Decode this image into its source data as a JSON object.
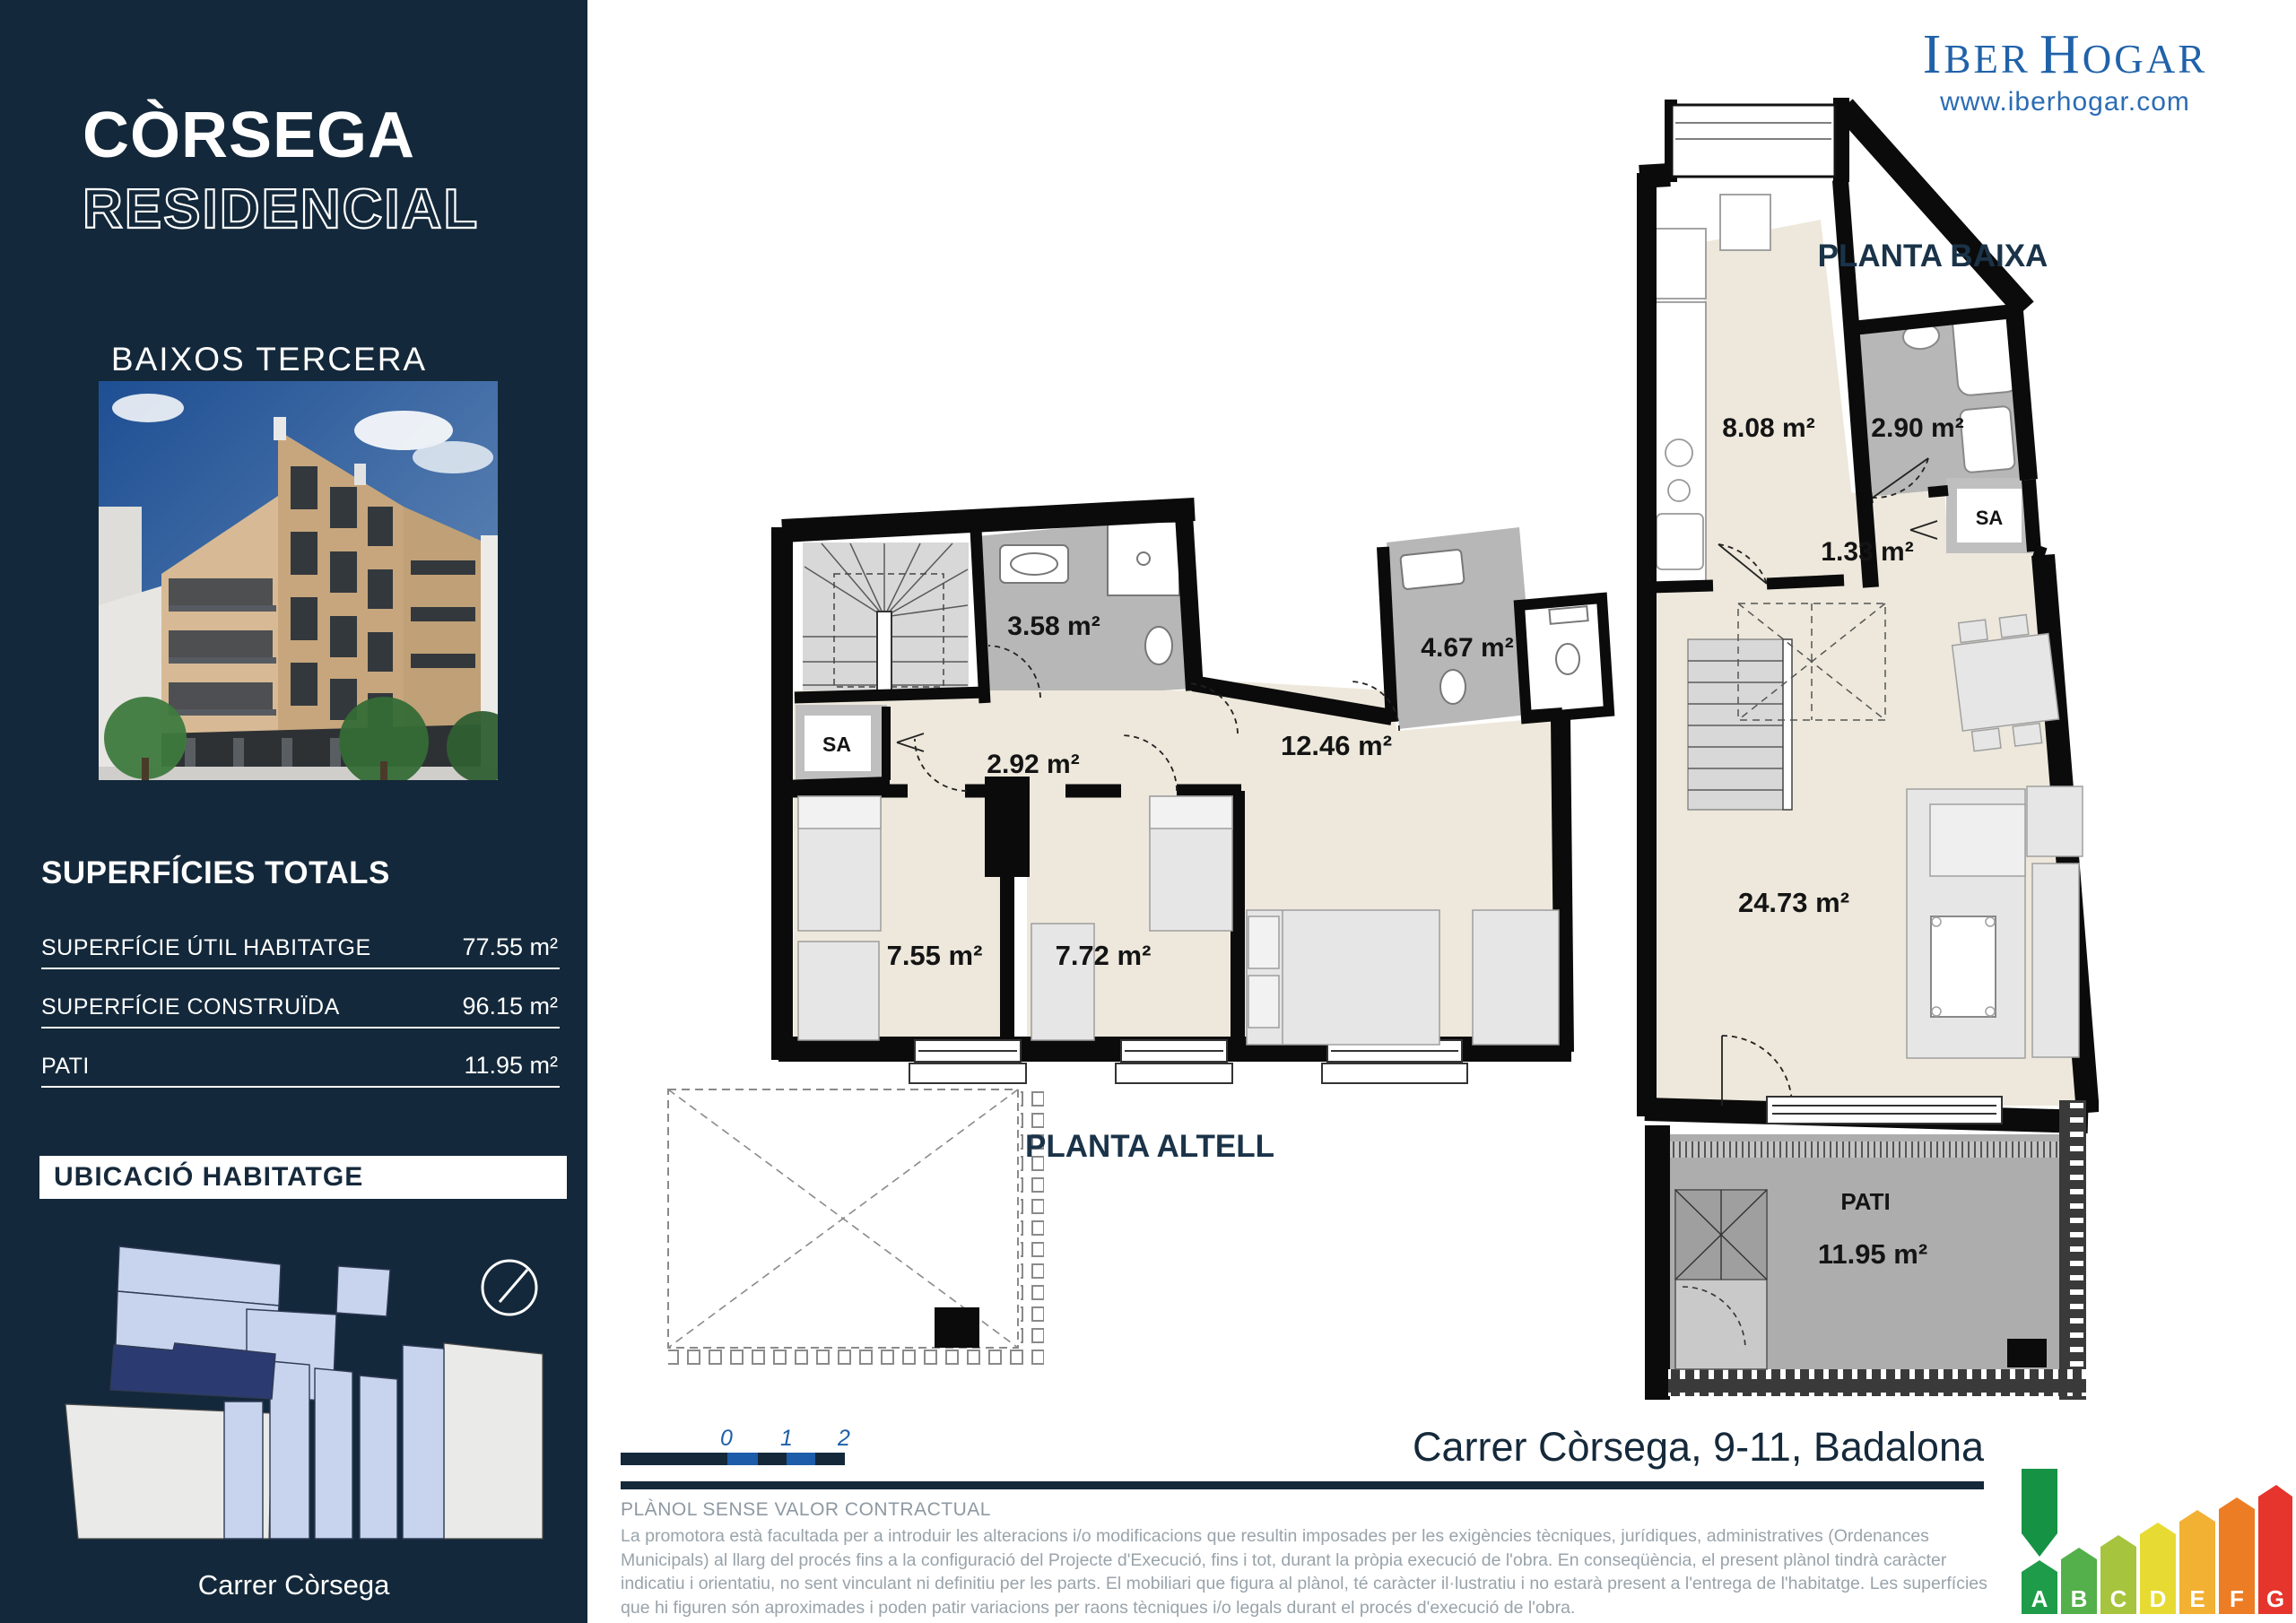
{
  "brand": {
    "navy": "#13283A",
    "logo_blue": "#2062A9",
    "accent_blue": "#1D5CA9",
    "site_highlight": "#2B3B72",
    "site_block_blue": "#C8D4EE"
  },
  "sidebar": {
    "title_line1": "CÒRSEGA",
    "title_line2": "RESIDENCIAL",
    "subtitle": "BAIXOS TERCERA",
    "superficies": {
      "heading": "SUPERFÍCIES TOTALS",
      "rows": [
        {
          "label": "SUPERFÍCIE ÚTIL HABITATGE",
          "value": "77.55 m²"
        },
        {
          "label": "SUPERFÍCIE CONSTRUÏDA",
          "value": "96.15 m²"
        },
        {
          "label": "PATI",
          "value": "11.95 m²"
        }
      ]
    },
    "ubicacio_heading": "UBICACIÓ HABITATGE",
    "street_label": "Carrer Còrsega"
  },
  "logo": {
    "i": "I",
    "ber": "BER",
    "h": "H",
    "ogar": "OGAR",
    "website": "www.iberhogar.com"
  },
  "plans": {
    "altell": {
      "title": "PLANTA ALTELL",
      "bath_top": "3.58 m²",
      "hall": "2.92 m²",
      "sa": "SA",
      "bedroom1": "7.55 m²",
      "bedroom2": "7.72 m²",
      "bedroom3": "12.46 m²",
      "bath_right": "4.67 m²"
    },
    "baixa": {
      "title": "PLANTA BAIXA",
      "kitchen": "8.08 m²",
      "bath": "2.90 m²",
      "hall": "1.33 m²",
      "sa": "SA",
      "living": "24.73 m²",
      "pati_title": "PATI",
      "pati_area": "11.95 m²"
    }
  },
  "scalebar": {
    "labels": [
      "0",
      "1",
      "2"
    ]
  },
  "address": "Carrer Còrsega, 9-11, Badalona",
  "disclaimer": {
    "title": "PLÀNOL SENSE VALOR CONTRACTUAL",
    "body": "La promotora està facultada per a introduir les alteracions i/o modificacions que resultin imposades per les exigències tècniques, jurídiques, administratives (Ordenances Municipals) al llarg del procés fins a la configuració del Projecte d'Execució, fins i tot, durant la pròpia execució de l'obra. En conseqüència, el present plànol tindrà caràcter indicatiu i orientatiu, no sent vinculant ni definitiu per les parts. El mobiliari que figura al plànol, té caràcter il·lustratiu i no estarà present a l'entrega de l'habitatge. Les superfícies que hi figuren són aproximades i poden patir variacions per raons tècniques i/o legals durant el procés d'execució de l'obra."
  },
  "energy": {
    "arrow_color": "#169245",
    "letters": [
      {
        "label": "A",
        "color": "#1E9C49"
      },
      {
        "label": "B",
        "color": "#54B04A"
      },
      {
        "label": "C",
        "color": "#A6C43D"
      },
      {
        "label": "D",
        "color": "#E7DB33"
      },
      {
        "label": "E",
        "color": "#F2B133"
      },
      {
        "label": "F",
        "color": "#EC7D24"
      },
      {
        "label": "G",
        "color": "#E6352C"
      }
    ]
  }
}
